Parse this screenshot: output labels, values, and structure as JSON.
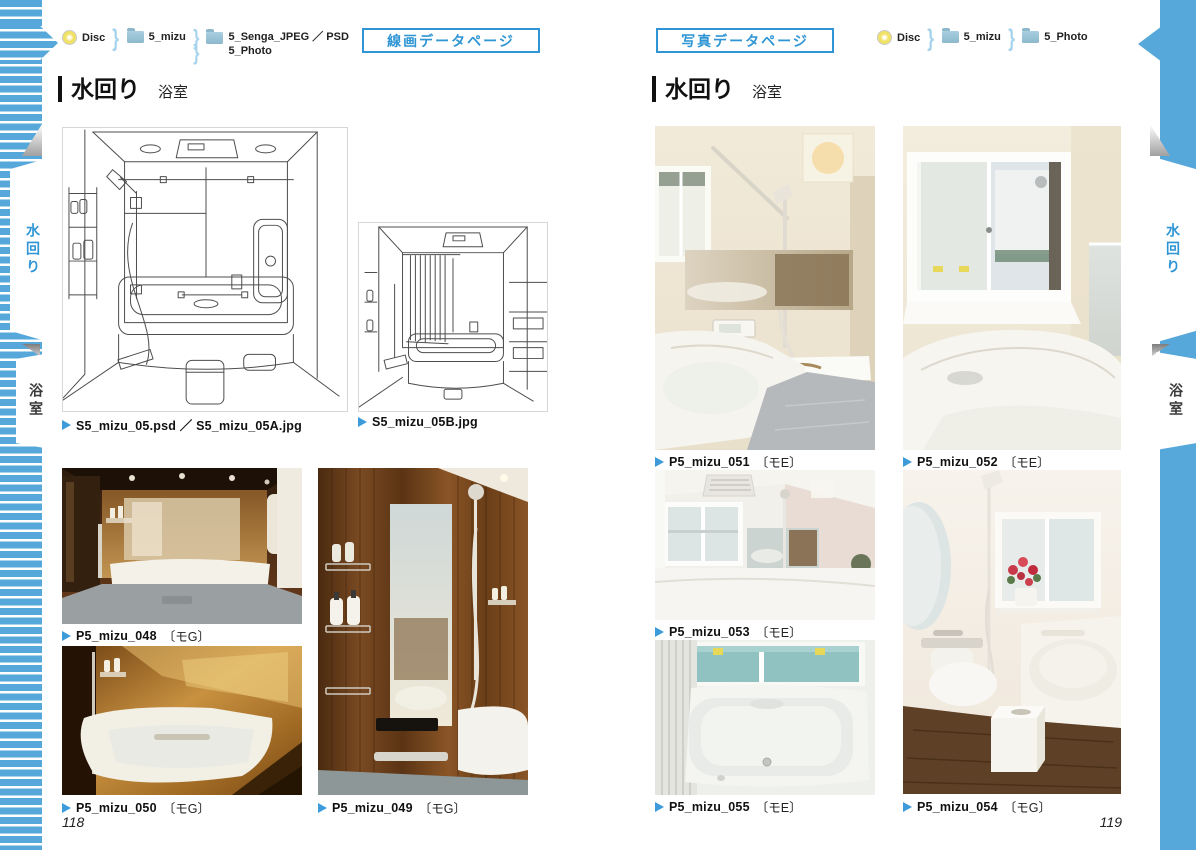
{
  "colors": {
    "band_blue": "#56a8da",
    "accent_blue": "#2f95d4",
    "caption_flag_blue": "#3d9bd9"
  },
  "icons": {
    "separator_glyph": "}"
  },
  "side_tabs": {
    "water_label": "水回り",
    "bath_label": "浴室"
  },
  "left_page": {
    "page_label": "線画データページ",
    "breadcrumb": {
      "items": [
        {
          "icon": "disc-icon",
          "label": "Disc"
        },
        {
          "icon": "folder-icon",
          "label": "5_mizu"
        },
        {
          "icon": "folder-icon",
          "label": "5_Senga_JPEG ／ PSD",
          "label2": "5_Photo"
        }
      ]
    },
    "section_title": "水回り",
    "section_subtitle": "浴室",
    "figures": {
      "senga_main": {
        "caption": "S5_mizu_05.psd ／ S5_mizu_05A.jpg"
      },
      "senga_sub": {
        "caption": "S5_mizu_05B.jpg"
      },
      "photo_048": {
        "caption": "P5_mizu_048",
        "tag": "〔モG〕"
      },
      "photo_050": {
        "caption": "P5_mizu_050",
        "tag": "〔モG〕"
      },
      "photo_049": {
        "caption": "P5_mizu_049",
        "tag": "〔モG〕"
      }
    },
    "page_number": "118"
  },
  "right_page": {
    "page_label": "写真データページ",
    "breadcrumb": {
      "items": [
        {
          "icon": "disc-icon",
          "label": "Disc"
        },
        {
          "icon": "folder-icon",
          "label": "5_mizu"
        },
        {
          "icon": "folder-icon",
          "label": "5_Photo"
        }
      ]
    },
    "section_title": "水回り",
    "section_subtitle": "浴室",
    "figures": {
      "photo_051": {
        "caption": "P5_mizu_051",
        "tag": "〔モE〕"
      },
      "photo_052": {
        "caption": "P5_mizu_052",
        "tag": "〔モE〕"
      },
      "photo_053": {
        "caption": "P5_mizu_053",
        "tag": "〔モE〕"
      },
      "photo_055": {
        "caption": "P5_mizu_055",
        "tag": "〔モE〕"
      },
      "photo_054": {
        "caption": "P5_mizu_054",
        "tag": "〔モG〕"
      }
    },
    "page_number": "119"
  }
}
